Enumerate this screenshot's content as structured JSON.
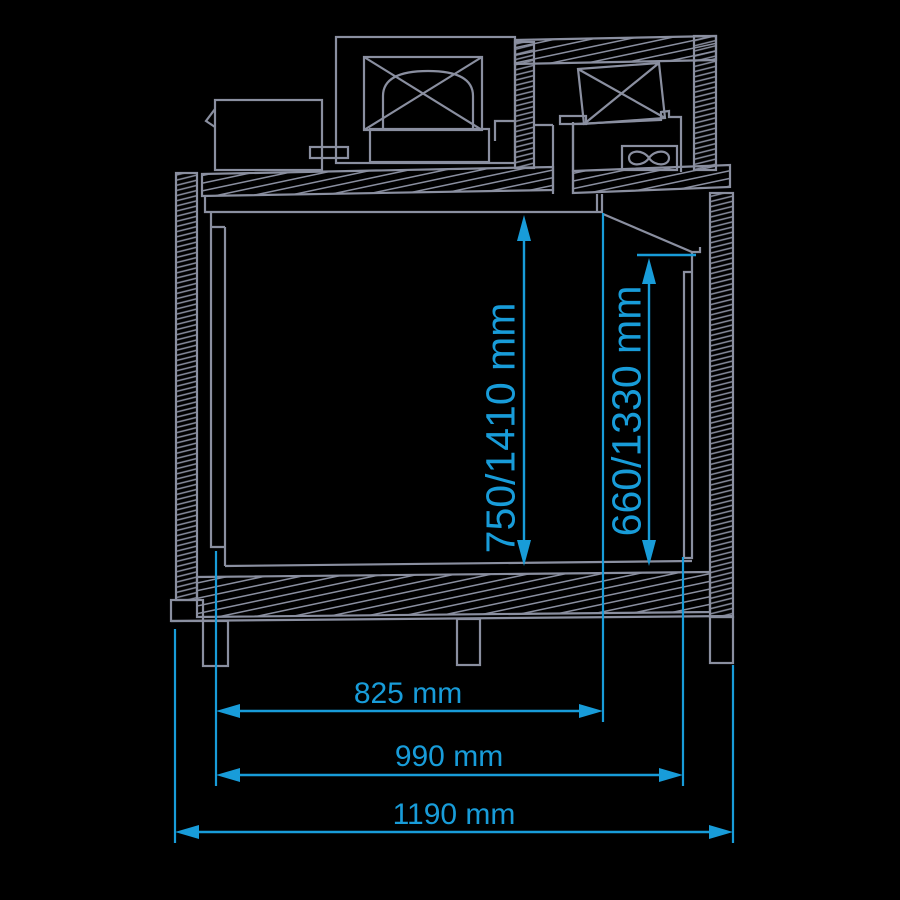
{
  "colors": {
    "background": "#000000",
    "line": "#8A8FA0",
    "dimension": "#189CD9"
  },
  "diagram": {
    "dimensions": {
      "interior_height": "750/1410 mm",
      "opening_height": "660/1330 mm",
      "width_inner": "825 mm",
      "width_body": "990 mm",
      "width_overall": "1190 mm"
    }
  }
}
